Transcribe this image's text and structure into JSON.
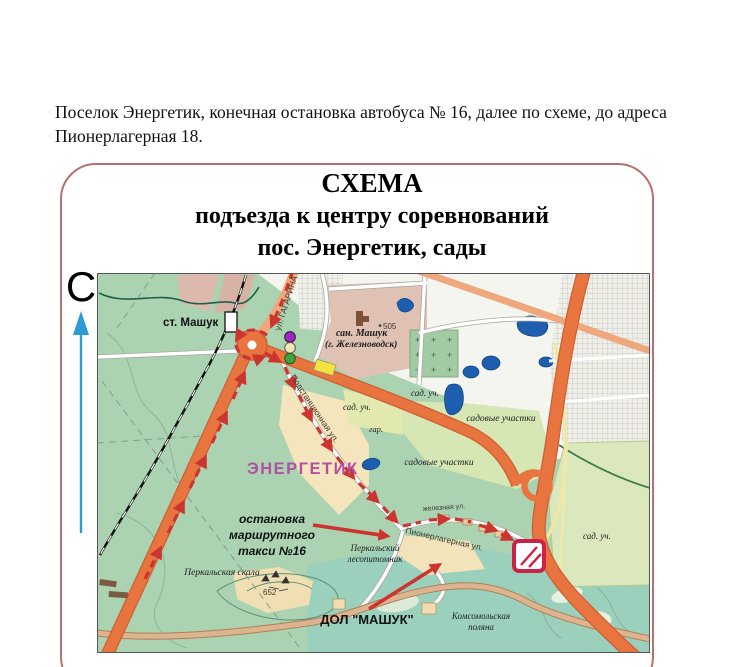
{
  "intro": {
    "line1": "Поселок Энергетик, конечная остановка автобуса № 16, далее по схеме, до адреса",
    "line2": "Пионерлагерная 18."
  },
  "scheme": {
    "title_line1": "СХЕМА",
    "title_line2": "подъезда к центру соревнований",
    "title_line3": "пос. Энергетик, сады",
    "compass_letter": "С"
  },
  "map": {
    "labels": {
      "st_mashuk": "ст. Машук",
      "ul_gagarina": "ул. ГАГАРИНА",
      "podstantsionnaya": "Подстанционная ул.",
      "pionerlagernaya": "Пионерлагерная ул.",
      "zheleznaya": "железная ул.",
      "san_mashuk_line1": "сан. Машук",
      "san_mashuk_line2": "(г. Железноводск)",
      "elev_505": "505",
      "elev_652": "652",
      "sad_uch": "сад. уч.",
      "gar": "гар.",
      "sadovye_uchastki": "садовые участки",
      "energetik": "ЭНЕРГЕТИК",
      "ostanovka_line1": "остановка",
      "ostanovka_line2": "маршрутного",
      "ostanovka_line3": "такси №16",
      "perkalskaya_skala": "Перкальская скала",
      "perkalsky_line1": "Перкальский",
      "perkalsky_line2": "лесопитомник",
      "dol_mashuk": "ДОЛ \"МАШУК\"",
      "komsomolskaya_line1": "Комсомольская",
      "komsomolskaya_line2": "поляна"
    }
  },
  "colors": {
    "route_red": "#cc3430",
    "road_orange": "#e8743f",
    "road_casing": "#cf5f33",
    "road_salmon": "#efa77d",
    "lake_blue": "#1d5fae",
    "marker_crimson": "#cc2244",
    "magenta": "#b052a0",
    "compass_blue": "#2e9ad6",
    "dot_purple": "#a722c9",
    "dot_cream": "#f5e6b8",
    "dot_green": "#3fa33f",
    "box_border": "#b97070"
  }
}
